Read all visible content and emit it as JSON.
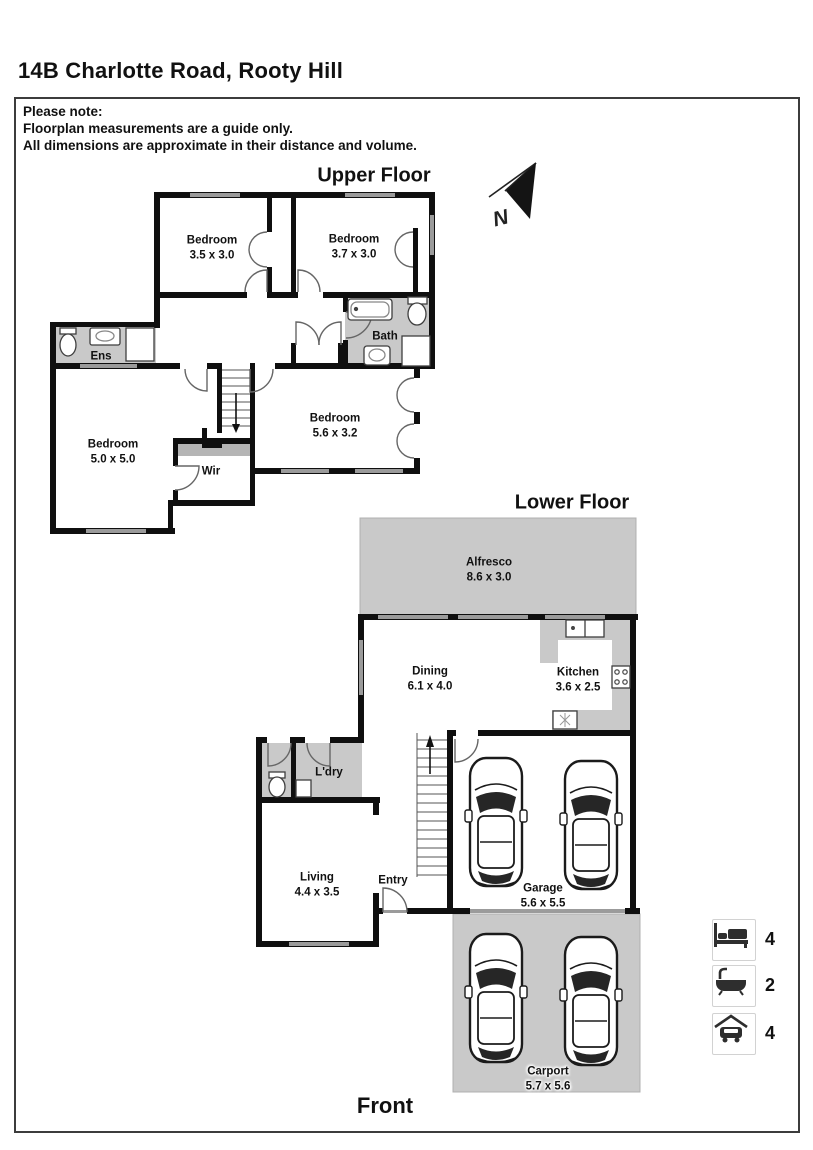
{
  "page": {
    "title": "14B Charlotte Road, Rooty Hill",
    "note": {
      "line1": "Please note:",
      "line2": "Floorplan measurements are a guide only.",
      "line3": "All dimensions are approximate in their distance and volume."
    },
    "front_label": "Front",
    "north_label": "N"
  },
  "floors": {
    "upper": {
      "label": "Upper Floor",
      "rooms": {
        "bedroom1": {
          "name": "Bedroom",
          "dims": "3.5 x 3.0"
        },
        "bedroom2": {
          "name": "Bedroom",
          "dims": "3.7 x 3.0"
        },
        "bedroom3": {
          "name": "Bedroom",
          "dims": "5.6 x 3.2"
        },
        "bedroom4": {
          "name": "Bedroom",
          "dims": "5.0 x 5.0"
        },
        "bath": {
          "name": "Bath"
        },
        "ens": {
          "name": "Ens"
        },
        "wir": {
          "name": "Wir"
        }
      }
    },
    "lower": {
      "label": "Lower Floor",
      "rooms": {
        "alfresco": {
          "name": "Alfresco",
          "dims": "8.6 x 3.0"
        },
        "dining": {
          "name": "Dining",
          "dims": "6.1 x 4.0"
        },
        "kitchen": {
          "name": "Kitchen",
          "dims": "3.6 x 2.5"
        },
        "laundry": {
          "name": "L'dry"
        },
        "living": {
          "name": "Living",
          "dims": "4.4 x 3.5"
        },
        "entry": {
          "name": "Entry"
        },
        "garage": {
          "name": "Garage",
          "dims": "5.6 x 5.5"
        },
        "carport": {
          "name": "Carport",
          "dims": "5.7 x 5.6"
        }
      }
    }
  },
  "legend": {
    "items": [
      {
        "icon": "bed-icon",
        "count": "4"
      },
      {
        "icon": "bath-icon",
        "count": "2"
      },
      {
        "icon": "car-icon",
        "count": "4"
      }
    ]
  },
  "colors": {
    "wall": "#0f0f0f",
    "wet_area_gray": "#c9c9c9",
    "window_gray": "#9b9b9b",
    "text": "#111111"
  }
}
